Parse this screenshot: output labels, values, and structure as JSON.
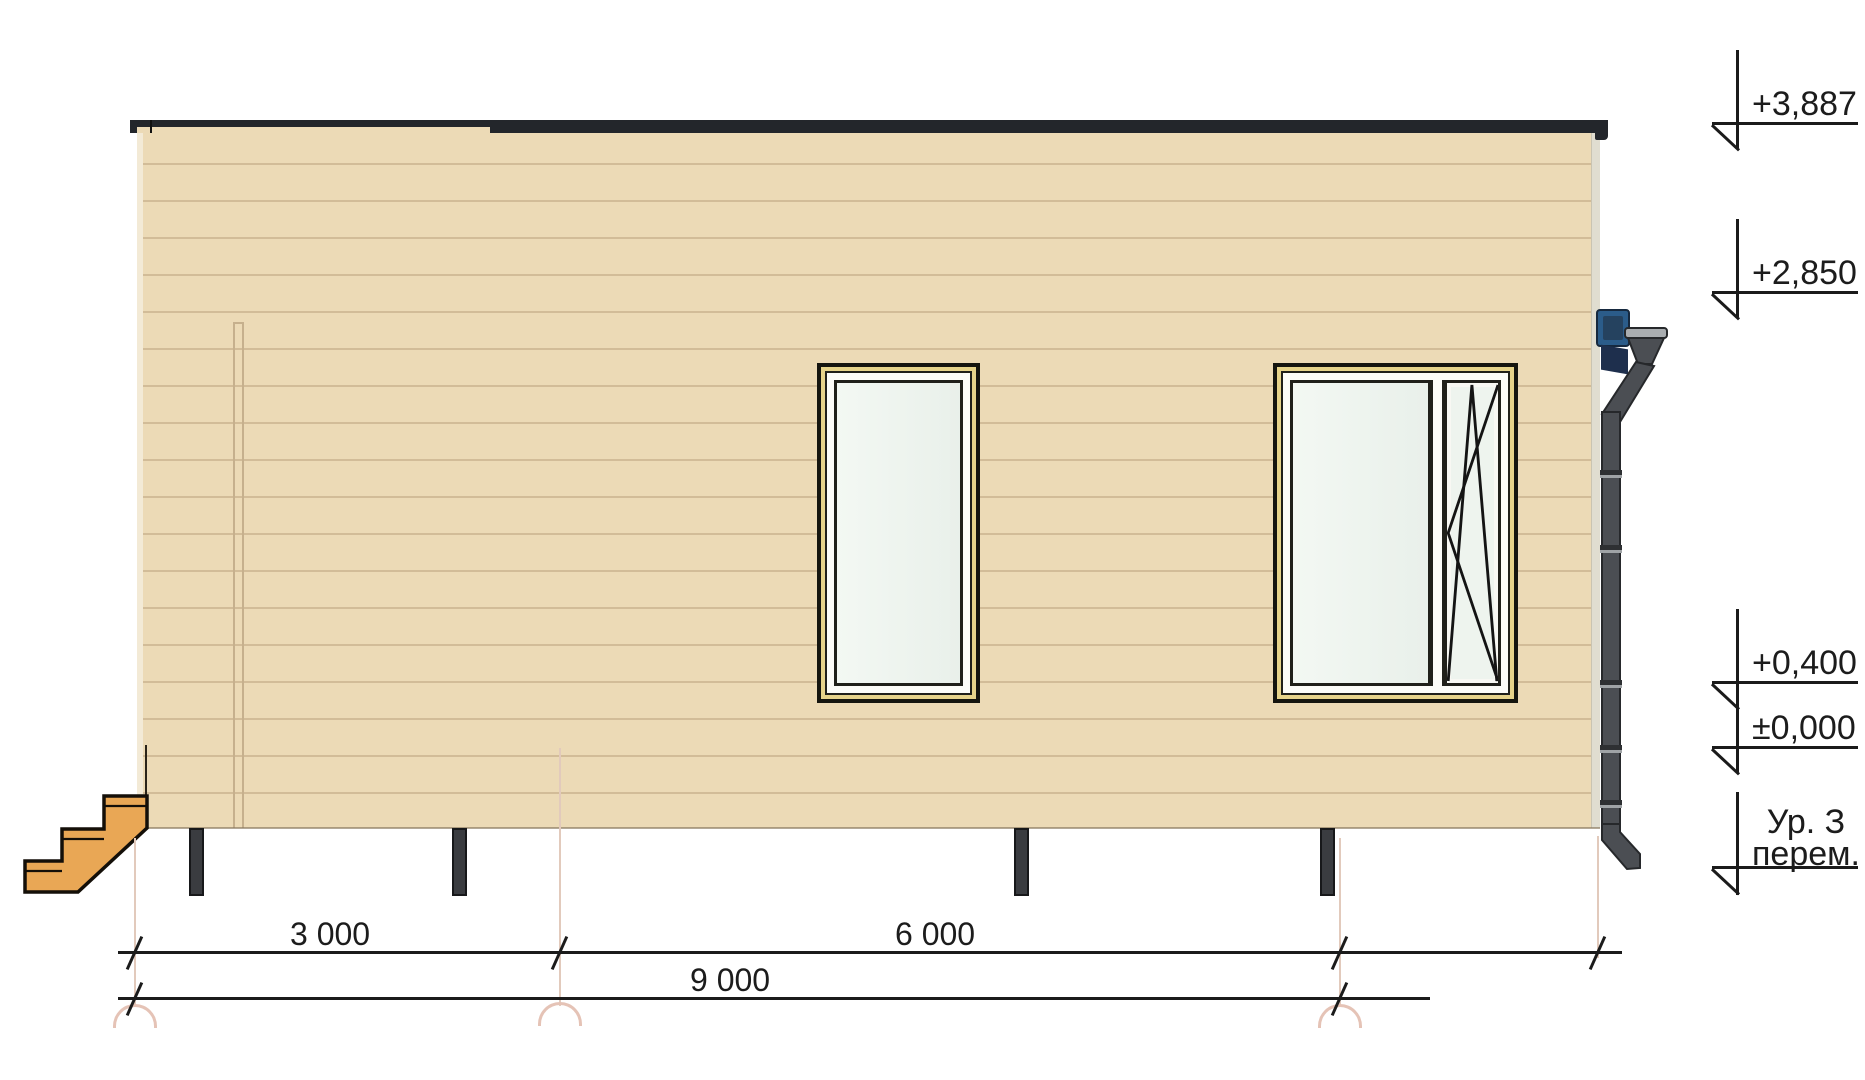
{
  "drawing_kind": "house-side-elevation",
  "elevation_marks": [
    {
      "label": "+3,887"
    },
    {
      "label": "+2,850"
    },
    {
      "label": "+0,400"
    },
    {
      "label": "±0,000"
    },
    {
      "label_line1": "Ур. З",
      "label_line2": "перем."
    }
  ],
  "dimensions": {
    "segment_left": "3 000",
    "segment_right": "6 000",
    "total": "9 000"
  },
  "colors": {
    "wall": "#ecdab6",
    "siding_line": "#d2bc98",
    "roof_fascia": "#23262b",
    "steps": "#e9a755",
    "pile": "#3a3c40",
    "downspout": "#4b4e53",
    "junction_box": "#2b5c8a",
    "glass": "#eef4ee",
    "window_trim": "#e6d38a",
    "axis_extension": "#e2cabc"
  }
}
